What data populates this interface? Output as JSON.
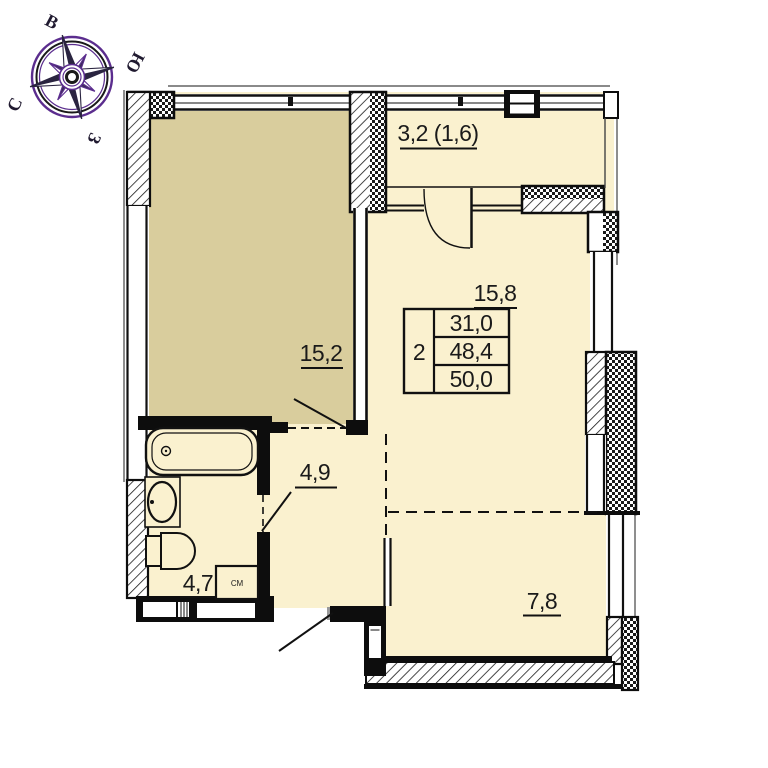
{
  "compass": {
    "north": "С",
    "south": "Ю",
    "east": "В",
    "west": "З"
  },
  "rooms": {
    "balcony": {
      "label": "3,2 (1,6)"
    },
    "bedroom": {
      "label": "15,2"
    },
    "living": {
      "label": "15,8"
    },
    "hall": {
      "label": "4,9"
    },
    "bath": {
      "label": "4,7"
    },
    "kitchen": {
      "label": "7,8"
    }
  },
  "area_table": {
    "rooms_count": "2",
    "row1": "31,0",
    "row2": "48,4",
    "row3": "50,0"
  },
  "marks": {
    "washer": "СМ"
  },
  "colors": {
    "room_dark": "#d9cd9d",
    "room_light": "#faf1cf",
    "wall": "#0d0d0d",
    "compass_accent": "#5b2d8e"
  }
}
